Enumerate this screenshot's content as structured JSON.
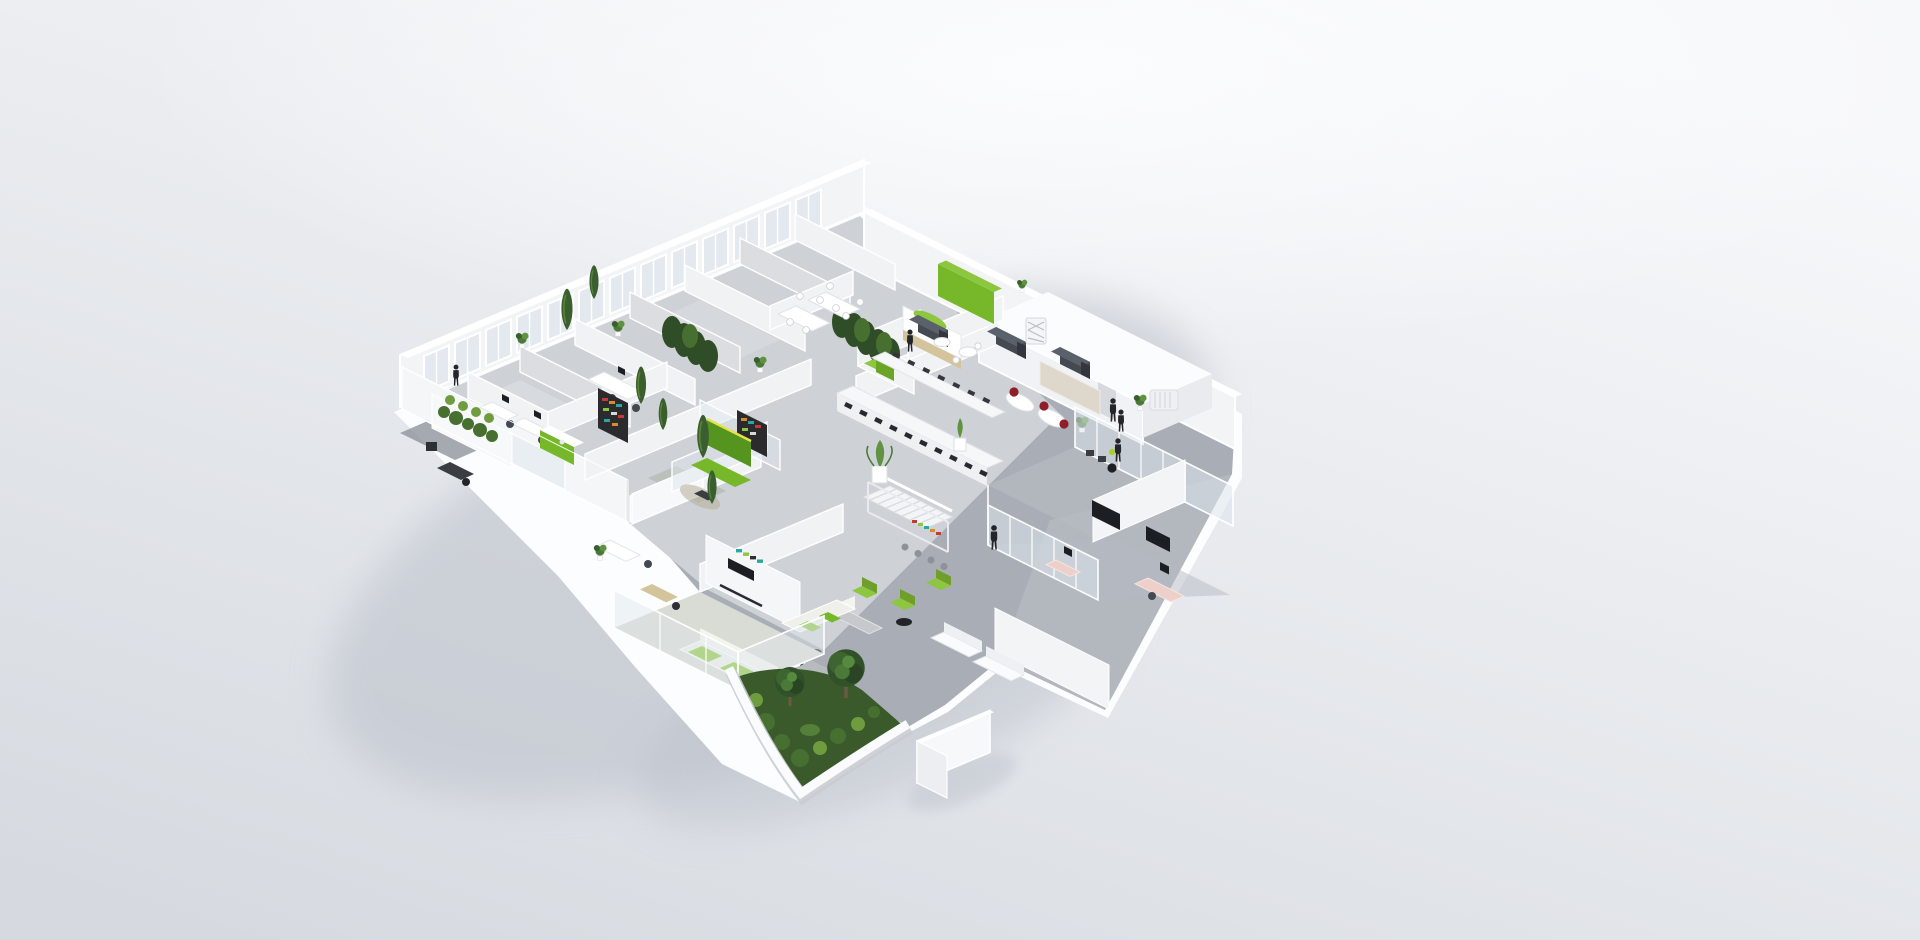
{
  "scene": {
    "people_count": 6,
    "garden_tree_count": 2,
    "facade_window_count": 13,
    "cafe_booth_count": 3
  },
  "colors": {
    "background_top": "#f7f8fa",
    "background_bottom": "#d6dae0",
    "background_glow": "#fcfdfe",
    "building_shadow": "#bcc1ca",
    "slab_white": "#fcfdfe",
    "wall_white": "#f3f4f6",
    "wall_top": "#ffffff",
    "wall_fabric": "#dcdde0",
    "glass_pane": "#dde6ec",
    "window_glass": "#e3e9ef",
    "floor_rooms": "#ced1d6",
    "floor_room_light": "#dadce0",
    "floor_hall": "#a9aeb6",
    "floor_hall_light": "#c6c9cf",
    "floor_tile_gray": "#979da6",
    "floor_wood": "#d3c49c",
    "accent_green": "#76b82a",
    "accent_green_bright": "#8dc63f",
    "accent_green_deep": "#55941f",
    "sofa_edge_yellow": "#e3e24b",
    "foliage_dark": "#2f4d26",
    "foliage_mid": "#477030",
    "foliage_light": "#6f9c3f",
    "garden_grass": "#3a5a2c",
    "booth_gray": "#4b5058",
    "chair_red": "#8e1f2a",
    "desk_pink": "#ecd0c9",
    "counter_white": "#f6f7f8",
    "screen_black": "#1b1e22",
    "figure_black": "#23252a",
    "bag_green": "#a9d11c",
    "table_gray": "#b7bbbd",
    "shelf_teal": "#2aa7a0",
    "shelf_orange": "#d98a2b",
    "shelf_red": "#c23b34",
    "trunk_brown": "#6b5a43"
  }
}
